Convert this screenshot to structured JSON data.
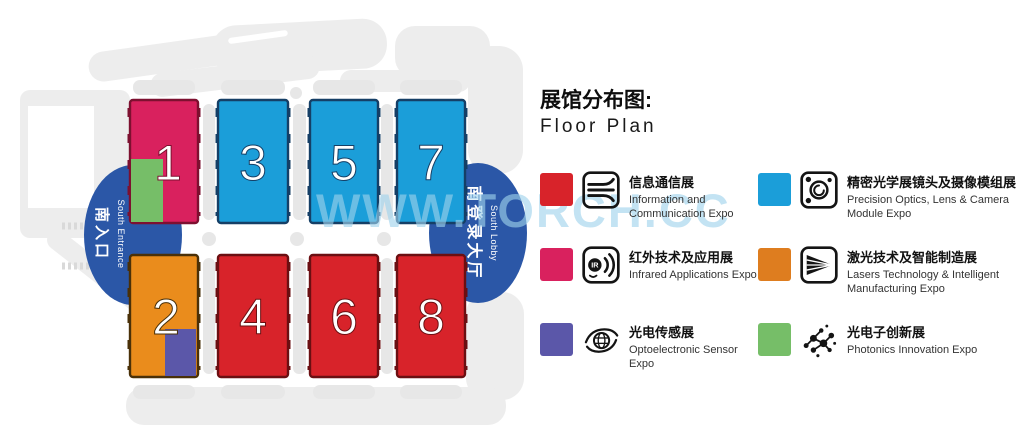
{
  "watermark": "WWW.TORCH.CC",
  "title": {
    "zh": "展馆分布图:",
    "en": "Floor Plan"
  },
  "entrance": {
    "zh": "南入口",
    "en": "South Entrance"
  },
  "lobby": {
    "zh": "南登录大厅",
    "en": "South Lobby"
  },
  "accent": {
    "ellipse_blue": "#2B57A7",
    "silhouette_gray": "#ededed"
  },
  "halls": {
    "h1": {
      "number": "1",
      "color": "#D9215E",
      "stroke": "#7D1030",
      "overlay": "#76BE68"
    },
    "h2": {
      "number": "2",
      "color": "#EA8C1C",
      "stroke": "#4A3008",
      "overlay": "#5B57A9"
    },
    "h3": {
      "number": "3",
      "color": "#1B9ED9",
      "stroke": "#153F66"
    },
    "h4": {
      "number": "4",
      "color": "#D8232A",
      "stroke": "#6B0F12"
    },
    "h5": {
      "number": "5",
      "color": "#1B9ED9",
      "stroke": "#153F66"
    },
    "h6": {
      "number": "6",
      "color": "#D8232A",
      "stroke": "#6B0F12"
    },
    "h7": {
      "number": "7",
      "color": "#1B9ED9",
      "stroke": "#153F66"
    },
    "h8": {
      "number": "8",
      "color": "#D8232A",
      "stroke": "#6B0F12"
    }
  },
  "legend": [
    {
      "icon": "communication-icon",
      "color": "#D8232A",
      "zh": "信息通信展",
      "en": "Information and Communication Expo"
    },
    {
      "icon": "camera-module-icon",
      "color": "#1B9ED9",
      "zh": "精密光学展镜头及摄像模组展",
      "en": "Precision Optics, Lens & Camera Module Expo"
    },
    {
      "icon": "infrared-icon",
      "color": "#D9215E",
      "zh": "红外技术及应用展",
      "en": "Infrared Applications Expo",
      "icon_text": "IR"
    },
    {
      "icon": "laser-icon",
      "color": "#DE7D1F",
      "zh": "激光技术及智能制造展",
      "en": "Lasers Technology & Intelligent Manufacturing Expo"
    },
    {
      "icon": "sensor-eye-icon",
      "color": "#5B57A9",
      "zh": "光电传感展",
      "en": "Optoelectronic Sensor Expo"
    },
    {
      "icon": "photonics-icon",
      "color": "#76BE68",
      "zh": "光电子创新展",
      "en": "Photonics Innovation Expo"
    }
  ]
}
